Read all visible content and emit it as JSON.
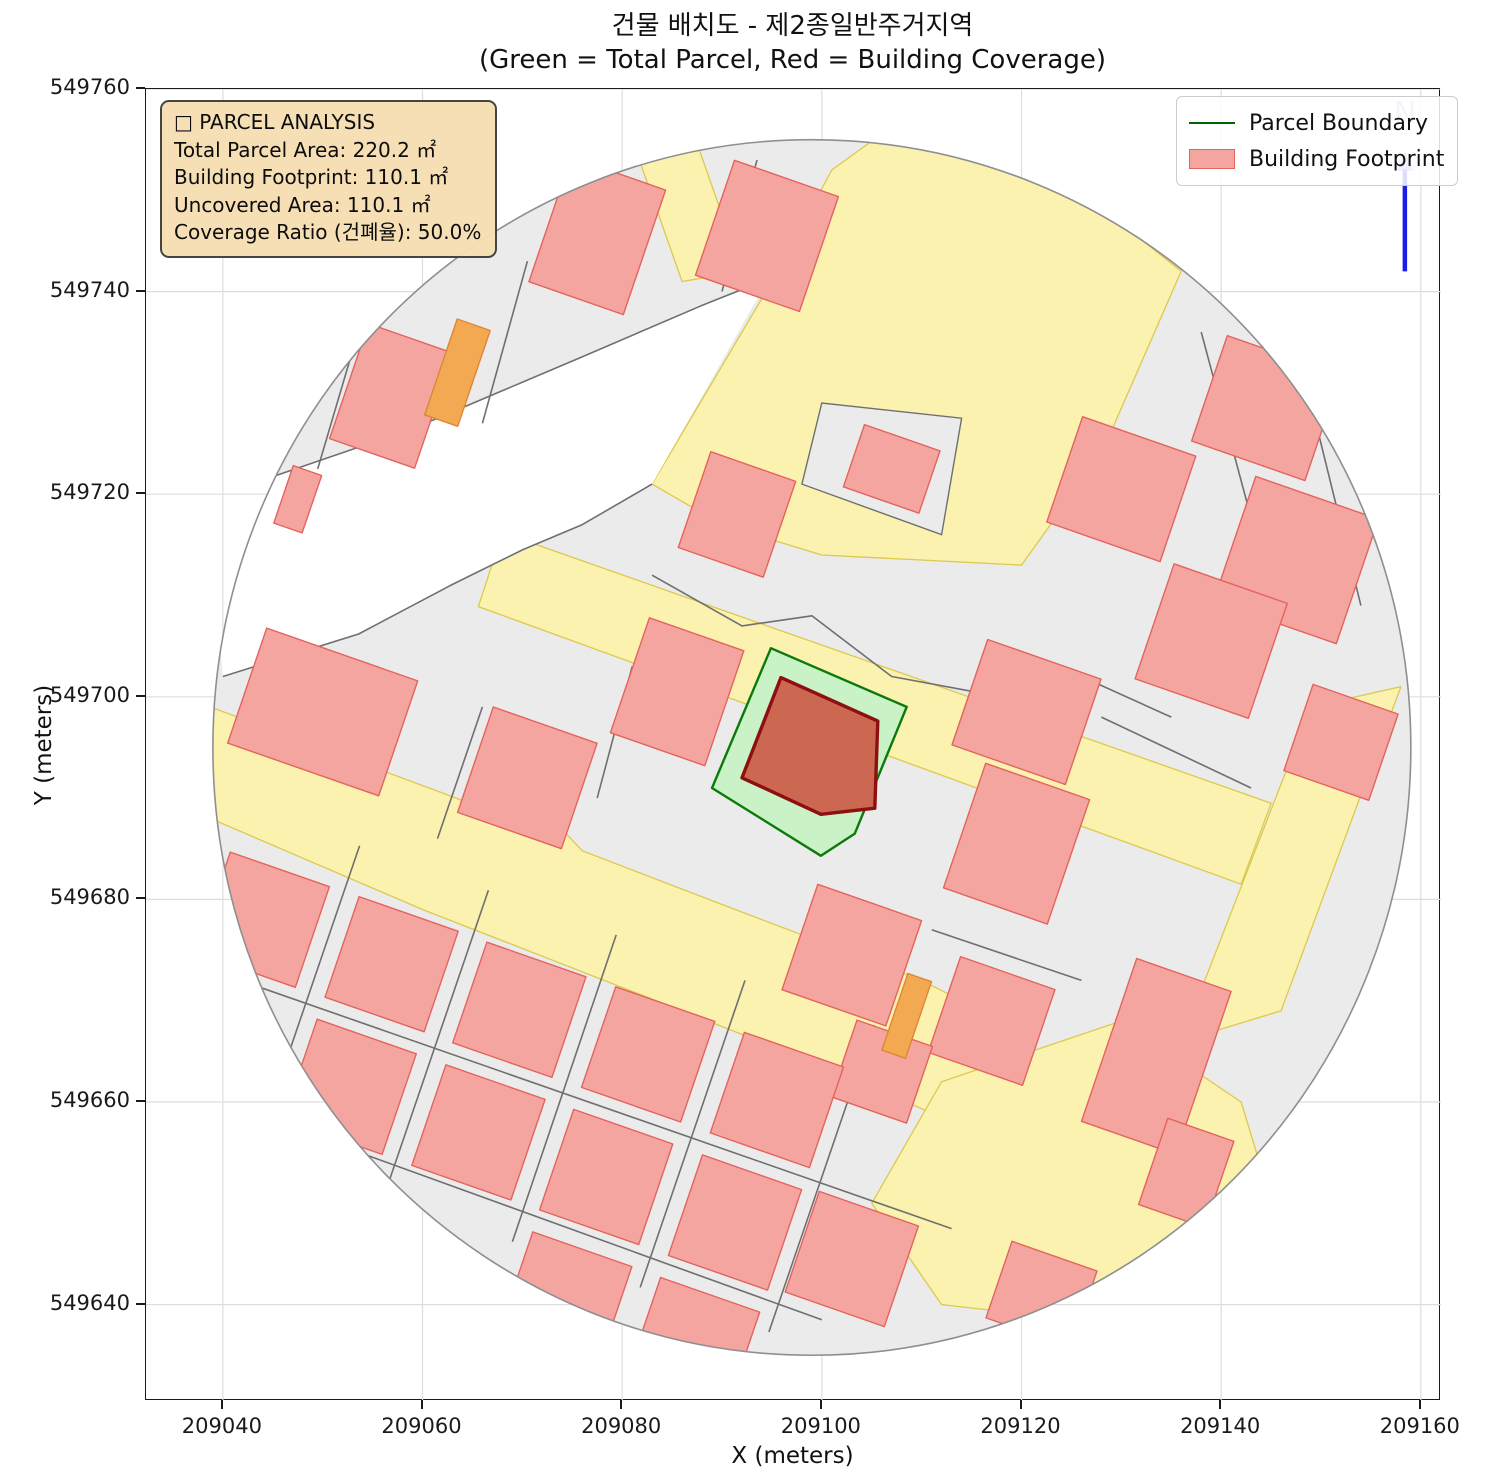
{
  "title": {
    "line1": "건물 배치도 - 제2종일반주거지역",
    "line2": "(Green = Total Parcel, Red = Building Coverage)"
  },
  "axes": {
    "xlabel": "X (meters)",
    "ylabel": "Y (meters)",
    "x_tick_labels": [
      "209040",
      "209060",
      "209080",
      "209100",
      "209120",
      "209140",
      "209160"
    ],
    "x_tick_values": [
      209040,
      209060,
      209080,
      209100,
      209120,
      209140,
      209160
    ],
    "y_tick_labels": [
      "549760",
      "549740",
      "549720",
      "549700",
      "549680",
      "549660",
      "549640"
    ],
    "y_tick_values": [
      549760,
      549740,
      549720,
      549700,
      549680,
      549660,
      549640
    ]
  },
  "legend": {
    "items": [
      {
        "label": "Parcel Boundary",
        "type": "line",
        "color": "#006400"
      },
      {
        "label": "Building Footprint",
        "type": "patch",
        "fill": "#f4a5a0",
        "stroke": "#e4635d"
      }
    ]
  },
  "info_box": {
    "title_line": "□ PARCEL ANALYSIS",
    "lines": [
      "Total Parcel Area:  220.2 ㎡",
      "Building Footprint:  110.1 ㎡",
      "Uncovered Area:  110.1 ㎡",
      "Coverage Ratio (건폐율): 50.0%"
    ]
  },
  "north": {
    "label": "N"
  },
  "colors": {
    "building_fill": "#f4a5a0",
    "building_stroke": "#e4635d",
    "orange_fill": "#f3a952",
    "orange_stroke": "#df8636",
    "road_fill": "#fbf2b0",
    "road_stroke": "#dcc94e",
    "base_fill": "#ebebeb",
    "base_stroke": "#8f8f8f",
    "parcel_line": "#6f6f6f",
    "subject_parcel_fill": "#c9f2c6",
    "subject_parcel_stroke": "#0b7a0b",
    "subject_building_fill": "#cc6852",
    "subject_building_stroke": "#8e0f0f",
    "north_blue": "#1c1ce8",
    "grid": "#dedede"
  },
  "map": {
    "grid_rotation_deg": -19,
    "circle": {
      "cx": 209099,
      "cy": 549695,
      "r": 60
    },
    "notch_wedge": [
      [
        209044.6,
        549721.6
      ],
      [
        209059.1,
        549726.5
      ],
      [
        209075.6,
        549733.4
      ],
      [
        209087.9,
        549738.6
      ],
      [
        209094.5,
        549741
      ],
      [
        209083,
        549721
      ],
      [
        209076,
        549717
      ],
      [
        209070,
        549714.5
      ],
      [
        209062.8,
        549711
      ],
      [
        209053.6,
        549706.2
      ],
      [
        209040,
        549702
      ],
      [
        209039.5,
        549708
      ],
      [
        209040.5,
        549714
      ],
      [
        209042.5,
        549719
      ]
    ],
    "roads": [
      [
        [
          209083,
          549721
        ],
        [
          209095,
          549741
        ],
        [
          209101,
          549752
        ],
        [
          209108,
          549757
        ],
        [
          209122,
          549753
        ],
        [
          209136,
          549742
        ],
        [
          209128,
          549724
        ],
        [
          209120,
          549713
        ],
        [
          209100,
          549714
        ],
        [
          209090,
          549717
        ]
      ],
      [
        [
          209068,
          549716.2
        ],
        [
          209145,
          549689.5
        ],
        [
          209142,
          549681.5
        ],
        [
          209065.6,
          549708.9
        ]
      ],
      [
        [
          209036,
          549700
        ],
        [
          209062,
          549690.5
        ],
        [
          209070,
          549687.5
        ],
        [
          209071.5,
          549689.5
        ],
        [
          209076,
          549684.8
        ],
        [
          209090,
          549679.5
        ],
        [
          209110,
          549672
        ],
        [
          209118,
          549668
        ],
        [
          209113,
          549658
        ],
        [
          209104,
          549662
        ],
        [
          209086,
          549669
        ],
        [
          209060,
          549679
        ],
        [
          209034,
          549690
        ]
      ],
      [
        [
          209112,
          549662
        ],
        [
          209130,
          549668
        ],
        [
          209142,
          549660
        ],
        [
          209146,
          549647
        ],
        [
          209130,
          549638
        ],
        [
          209112,
          549640
        ],
        [
          209105,
          549650
        ]
      ],
      [
        [
          209136,
          549666
        ],
        [
          209146,
          549669
        ],
        [
          209158,
          549701
        ],
        [
          209149,
          549699
        ]
      ],
      [
        [
          209086,
          549741
        ],
        [
          209092,
          549742
        ],
        [
          209087,
          549756
        ],
        [
          209081,
          549755
        ]
      ]
    ],
    "gray_islands": [
      [
        [
          209098,
          549721
        ],
        [
          209100,
          549729
        ],
        [
          209114,
          549727.5
        ],
        [
          209112,
          549716
        ]
      ]
    ],
    "parcel_lines": [
      [
        [
          209040,
          549702
        ],
        [
          209053.6,
          549706.2
        ],
        [
          209062.8,
          549711
        ],
        [
          209070,
          549714.5
        ],
        [
          209076,
          549717
        ],
        [
          209083,
          549721
        ]
      ],
      [
        [
          209044.6,
          549721.6
        ],
        [
          209059.1,
          549726.5
        ],
        [
          209075.6,
          549733.4
        ],
        [
          209087.9,
          549738.6
        ],
        [
          209094,
          549741
        ]
      ],
      [
        [
          209049.5,
          549722.5
        ],
        [
          209054,
          549737.5
        ]
      ],
      [
        [
          209066,
          549727
        ],
        [
          209070.5,
          549743
        ]
      ],
      [
        [
          209090,
          549740
        ],
        [
          209093.5,
          549753
        ]
      ],
      [
        [
          209061.5,
          549686
        ],
        [
          209066,
          549699
        ]
      ],
      [
        [
          209077.5,
          549690
        ],
        [
          209081,
          549703
        ]
      ],
      [
        [
          209083,
          549712
        ],
        [
          209092,
          549707
        ],
        [
          209099,
          549708
        ],
        [
          209107,
          549702
        ],
        [
          209118,
          549700
        ],
        [
          209126,
          549702
        ],
        [
          209135,
          549698
        ]
      ],
      [
        [
          209138,
          549736
        ],
        [
          209144,
          549714
        ]
      ],
      [
        [
          209149,
          549729
        ],
        [
          209154,
          549709
        ]
      ],
      [
        [
          209128,
          549698
        ],
        [
          209143,
          549691
        ]
      ],
      [
        [
          209040,
          549672.6
        ],
        [
          209113,
          549647.5
        ]
      ],
      [
        [
          209038,
          549660.6
        ],
        [
          209100,
          549638.5
        ]
      ],
      [
        [
          209043.2,
          549655
        ],
        [
          209053.7,
          549685.3
        ]
      ],
      [
        [
          209056.1,
          549650.6
        ],
        [
          209066.6,
          549680.9
        ]
      ],
      [
        [
          209069,
          549646.2
        ],
        [
          209079.4,
          549676.5
        ]
      ],
      [
        [
          209081.8,
          549641.7
        ],
        [
          209092.3,
          549672
        ]
      ],
      [
        [
          209094.7,
          549637.3
        ],
        [
          209105.2,
          549667.6
        ]
      ],
      [
        [
          209111,
          549677
        ],
        [
          209126,
          549672
        ]
      ]
    ],
    "buildings": [
      {
        "x": 209056.9,
        "y": 549729.7,
        "w": 9,
        "h": 12
      },
      {
        "x": 209063.5,
        "y": 549732.0,
        "w": 3.5,
        "h": 10,
        "c": "orange"
      },
      {
        "x": 209077.5,
        "y": 549745.5,
        "w": 10,
        "h": 13
      },
      {
        "x": 209094.5,
        "y": 549745.5,
        "w": 11,
        "h": 12
      },
      {
        "x": 209047.5,
        "y": 549719.5,
        "w": 3,
        "h": 6
      },
      {
        "x": 209050.0,
        "y": 549698.5,
        "w": 16,
        "h": 12
      },
      {
        "x": 209070.5,
        "y": 549692.0,
        "w": 11,
        "h": 11
      },
      {
        "x": 209085.5,
        "y": 549700.5,
        "w": 10,
        "h": 12
      },
      {
        "x": 209091.5,
        "y": 549718.0,
        "w": 9,
        "h": 10
      },
      {
        "x": 209107.0,
        "y": 549722.5,
        "w": 8,
        "h": 6.5
      },
      {
        "x": 209130.0,
        "y": 549720.5,
        "w": 12,
        "h": 11
      },
      {
        "x": 209144.5,
        "y": 549728.5,
        "w": 12,
        "h": 11
      },
      {
        "x": 209147.5,
        "y": 549713.5,
        "w": 13,
        "h": 13
      },
      {
        "x": 209139.0,
        "y": 549705.5,
        "w": 12,
        "h": 12
      },
      {
        "x": 209152.0,
        "y": 549695.5,
        "w": 9,
        "h": 9
      },
      {
        "x": 209120.5,
        "y": 549698.5,
        "w": 12,
        "h": 11
      },
      {
        "x": 209119.5,
        "y": 549685.5,
        "w": 11,
        "h": 13
      },
      {
        "x": 209117.0,
        "y": 549668.0,
        "w": 10,
        "h": 10
      },
      {
        "x": 209133.5,
        "y": 549664.5,
        "w": 10,
        "h": 17
      },
      {
        "x": 209103.0,
        "y": 549674.5,
        "w": 11,
        "h": 11
      },
      {
        "x": 209106.0,
        "y": 549663.0,
        "w": 8,
        "h": 8
      },
      {
        "x": 209108.5,
        "y": 549668.5,
        "w": 2.5,
        "h": 8,
        "c": "orange"
      },
      {
        "x": 209044.0,
        "y": 549678.0,
        "w": 10.5,
        "h": 10.5
      },
      {
        "x": 209056.9,
        "y": 549673.6,
        "w": 10.5,
        "h": 10.5
      },
      {
        "x": 209069.7,
        "y": 549669.1,
        "w": 10.5,
        "h": 10.5
      },
      {
        "x": 209082.6,
        "y": 549664.7,
        "w": 10.5,
        "h": 10.5
      },
      {
        "x": 209095.5,
        "y": 549660.2,
        "w": 10.5,
        "h": 10.5
      },
      {
        "x": 209052.7,
        "y": 549661.5,
        "w": 10.5,
        "h": 10.5
      },
      {
        "x": 209065.6,
        "y": 549657.0,
        "w": 10.5,
        "h": 10.5
      },
      {
        "x": 209078.4,
        "y": 549652.6,
        "w": 10.5,
        "h": 10.5
      },
      {
        "x": 209091.3,
        "y": 549648.1,
        "w": 10.5,
        "h": 10.5
      },
      {
        "x": 209103.0,
        "y": 549644.5,
        "w": 10.5,
        "h": 10.5
      },
      {
        "x": 209074.3,
        "y": 549640.5,
        "w": 10.5,
        "h": 10.5
      },
      {
        "x": 209087.1,
        "y": 549636.0,
        "w": 10.5,
        "h": 10.5
      },
      {
        "x": 209122.0,
        "y": 549641.0,
        "w": 9,
        "h": 8
      },
      {
        "x": 209136.5,
        "y": 549653.0,
        "w": 7,
        "h": 9
      }
    ],
    "subject_parcel": [
      [
        209094.9,
        549704.8
      ],
      [
        209108.5,
        549699.0
      ],
      [
        209103.3,
        549686.5
      ],
      [
        209099.9,
        549684.3
      ],
      [
        209089.0,
        549691.0
      ]
    ],
    "subject_building": [
      [
        209095.9,
        549701.9
      ],
      [
        209105.6,
        549697.6
      ],
      [
        209105.3,
        549689.0
      ],
      [
        209099.9,
        549688.4
      ],
      [
        209092.0,
        549692.0
      ]
    ],
    "north_arrow": {
      "x": 209158.4,
      "y_base": 549742.0,
      "y_tip": 549753.5
    }
  }
}
